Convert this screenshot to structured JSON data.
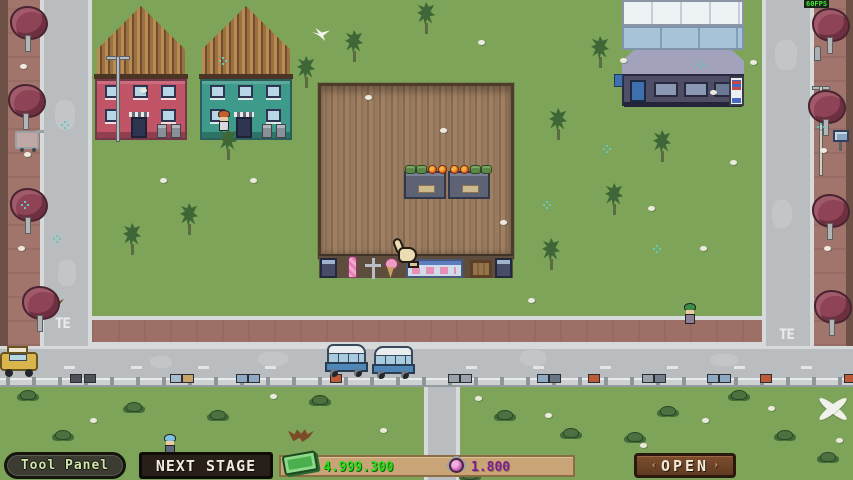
{
  "hud": {
    "tool_panel": "Tool Panel",
    "next_stage": "NEXT STAGE",
    "money": "4.999.300",
    "hearts": "1.800",
    "open": "OPEN",
    "open_deco_left": "‹",
    "open_deco_right": "›",
    "fps": "60FPS"
  },
  "road_markings": {
    "left": "TE",
    "right": "TE"
  },
  "colors": {
    "grass": "#7da458",
    "sidewalk": "#a1746c",
    "road": "#b9bdbf",
    "money_green": "#23e019",
    "hearts_purple": "#7d1d92",
    "wood_floor": "#9a7b5f",
    "ui_wood": "#c9a476",
    "pink_house": "#c25468",
    "teal_house": "#3e9a8a"
  },
  "scene": {
    "pine_trees": [
      {
        "x": 344,
        "y": 30
      },
      {
        "x": 590,
        "y": 36
      },
      {
        "x": 416,
        "y": 2
      },
      {
        "x": 548,
        "y": 108
      },
      {
        "x": 604,
        "y": 183
      },
      {
        "x": 541,
        "y": 238
      },
      {
        "x": 218,
        "y": 128
      },
      {
        "x": 179,
        "y": 203
      },
      {
        "x": 122,
        "y": 223
      },
      {
        "x": 296,
        "y": 56
      },
      {
        "x": 652,
        "y": 130
      }
    ],
    "maroon_trees": [
      {
        "x": 10,
        "y": 6
      },
      {
        "x": 8,
        "y": 84
      },
      {
        "x": 10,
        "y": 188
      },
      {
        "x": 22,
        "y": 286
      },
      {
        "x": 812,
        "y": 8
      },
      {
        "x": 808,
        "y": 90
      },
      {
        "x": 812,
        "y": 194
      },
      {
        "x": 814,
        "y": 290
      }
    ],
    "bushes": [
      {
        "x": 20,
        "y": 390
      },
      {
        "x": 126,
        "y": 402
      },
      {
        "x": 210,
        "y": 410
      },
      {
        "x": 312,
        "y": 395
      },
      {
        "x": 462,
        "y": 470
      },
      {
        "x": 497,
        "y": 410
      },
      {
        "x": 563,
        "y": 428
      },
      {
        "x": 627,
        "y": 432
      },
      {
        "x": 660,
        "y": 406
      },
      {
        "x": 731,
        "y": 390
      },
      {
        "x": 777,
        "y": 430
      },
      {
        "x": 820,
        "y": 452
      },
      {
        "x": 55,
        "y": 430
      }
    ],
    "stones": [
      {
        "x": 365,
        "y": 95
      },
      {
        "x": 478,
        "y": 40
      },
      {
        "x": 440,
        "y": 128
      },
      {
        "x": 250,
        "y": 178
      },
      {
        "x": 500,
        "y": 220
      },
      {
        "x": 648,
        "y": 206
      },
      {
        "x": 700,
        "y": 246
      },
      {
        "x": 710,
        "y": 90
      },
      {
        "x": 528,
        "y": 298
      },
      {
        "x": 160,
        "y": 178
      },
      {
        "x": 140,
        "y": 88
      },
      {
        "x": 620,
        "y": 58
      },
      {
        "x": 270,
        "y": 394
      },
      {
        "x": 90,
        "y": 418
      },
      {
        "x": 380,
        "y": 428
      },
      {
        "x": 475,
        "y": 396
      },
      {
        "x": 545,
        "y": 413
      },
      {
        "x": 640,
        "y": 443
      },
      {
        "x": 702,
        "y": 418
      },
      {
        "x": 768,
        "y": 406
      },
      {
        "x": 836,
        "y": 438
      },
      {
        "x": 20,
        "y": 64
      },
      {
        "x": 24,
        "y": 152
      },
      {
        "x": 18,
        "y": 246
      },
      {
        "x": 820,
        "y": 148
      },
      {
        "x": 824,
        "y": 246
      },
      {
        "x": 750,
        "y": 60
      },
      {
        "x": 730,
        "y": 160
      }
    ],
    "flowers": [
      {
        "x": 64,
        "y": 124
      },
      {
        "x": 56,
        "y": 238
      },
      {
        "x": 222,
        "y": 60
      },
      {
        "x": 606,
        "y": 148
      },
      {
        "x": 546,
        "y": 204
      },
      {
        "x": 656,
        "y": 248
      },
      {
        "x": 820,
        "y": 126
      },
      {
        "x": 700,
        "y": 64
      },
      {
        "x": 24,
        "y": 204
      }
    ],
    "rail_boxes": [
      {
        "x": 70,
        "c": "#4e5258"
      },
      {
        "x": 84,
        "c": "#4e5258"
      },
      {
        "x": 170,
        "c": "#a8bccf"
      },
      {
        "x": 182,
        "c": "#c8a46a"
      },
      {
        "x": 236,
        "c": "#8fa9c4"
      },
      {
        "x": 248,
        "c": "#8fa9c4"
      },
      {
        "x": 330,
        "c": "#bf5a38"
      },
      {
        "x": 448,
        "c": "#9aa2ac"
      },
      {
        "x": 460,
        "c": "#9aa2ac"
      },
      {
        "x": 537,
        "c": "#8fa9c4"
      },
      {
        "x": 549,
        "c": "#6a7686"
      },
      {
        "x": 588,
        "c": "#bf5a38"
      },
      {
        "x": 642,
        "c": "#9aa2ac"
      },
      {
        "x": 654,
        "c": "#747e8a"
      },
      {
        "x": 707,
        "c": "#8fa9c4"
      },
      {
        "x": 719,
        "c": "#8fa9c4"
      },
      {
        "x": 760,
        "c": "#bf5a38"
      },
      {
        "x": 844,
        "c": "#bf5a38"
      }
    ],
    "dashes": [
      64,
      131,
      198,
      265,
      332,
      399,
      466,
      533,
      600,
      667,
      734,
      801
    ],
    "road_patches": [
      {
        "x": 258,
        "y": 352,
        "w": 30,
        "h": 14
      },
      {
        "x": 520,
        "y": 350,
        "w": 26,
        "h": 16
      },
      {
        "x": 710,
        "y": 354,
        "w": 28,
        "h": 12
      },
      {
        "x": 55,
        "y": 100,
        "w": 20,
        "h": 30
      },
      {
        "x": 58,
        "y": 260,
        "w": 18,
        "h": 26
      },
      {
        "x": 775,
        "y": 40,
        "w": 22,
        "h": 30
      },
      {
        "x": 772,
        "y": 200,
        "w": 20,
        "h": 28
      },
      {
        "x": 150,
        "y": 356,
        "w": 22,
        "h": 12
      }
    ]
  }
}
